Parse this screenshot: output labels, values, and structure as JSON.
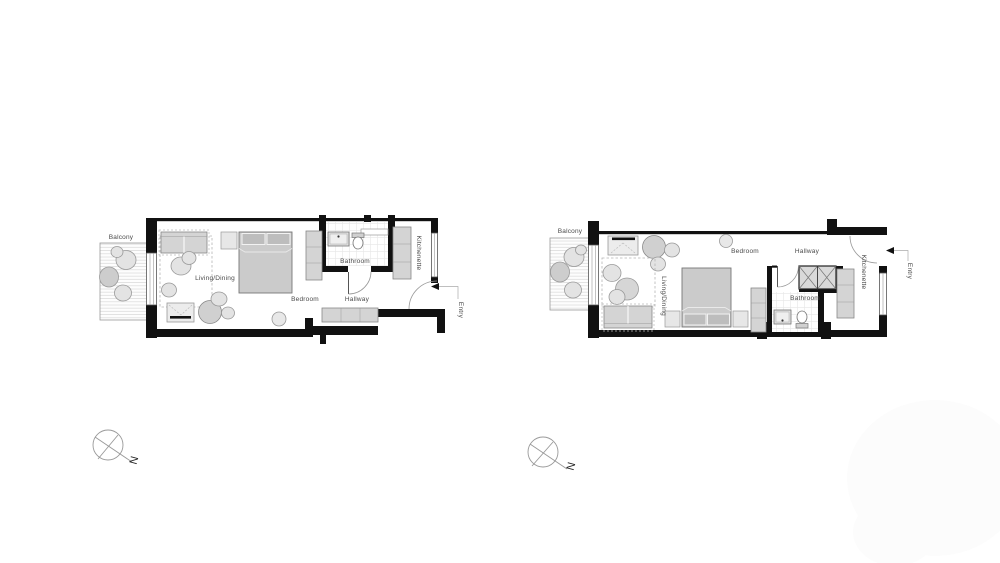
{
  "plans": [
    {
      "name": "left-unit",
      "labels": {
        "balcony": "Balcony",
        "living_dining": "Living/Dining",
        "bedroom": "Bedroom",
        "bathroom": "Bathroom",
        "hallway": "Hallway",
        "kitchenette": "Kitchenette",
        "entry": "Entry"
      }
    },
    {
      "name": "right-unit",
      "labels": {
        "balcony": "Balcony",
        "living_dining": "Living/Dining",
        "bedroom": "Bedroom",
        "bathroom": "Bathroom",
        "hallway": "Hallway",
        "kitchenette": "Kitchenette",
        "entry": "Entry"
      }
    }
  ],
  "compass": {
    "north_label": "N"
  },
  "colors": {
    "background": "#ffffff",
    "wall": "#111111",
    "furniture_fill": "#d4d4d4",
    "furniture_stroke": "#888888",
    "label_text": "#4a4a4a",
    "watermark": "#fcfcfc"
  }
}
